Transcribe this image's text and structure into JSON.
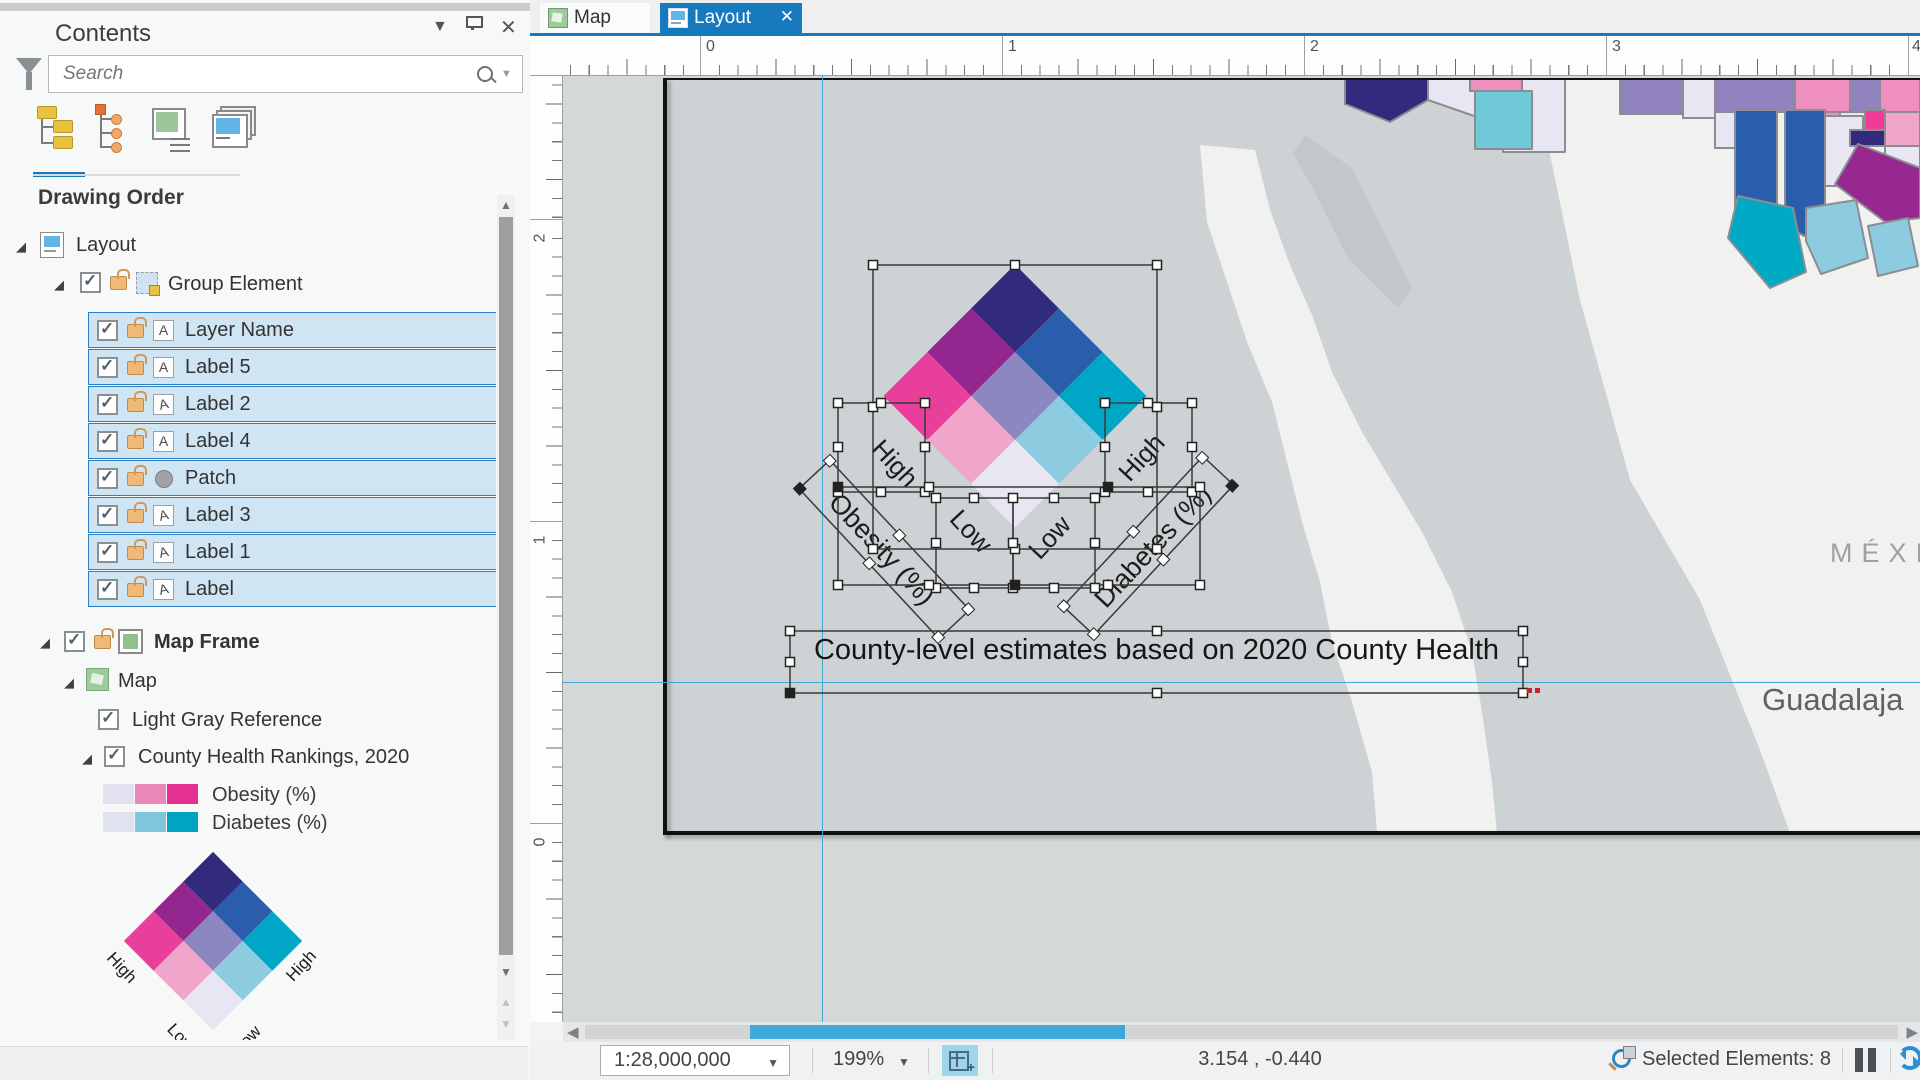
{
  "contents_panel": {
    "title": "Contents",
    "search": {
      "placeholder": "Search"
    },
    "drawing_order_heading": "Drawing Order",
    "tree": {
      "layout": "Layout",
      "group_element": "Group Element",
      "selected_items": [
        "Layer Name",
        "Label 5",
        "Label 2",
        "Label 4",
        "Patch",
        "Label 3",
        "Label 1",
        "Label"
      ],
      "map_frame": "Map Frame",
      "map": "Map",
      "light_gray_layer": "Light Gray Reference",
      "county_health_layer": "County Health Rankings, 2020",
      "legend": [
        {
          "label": "Obesity (%)",
          "ramp": [
            "#e5e0ef",
            "#ec87ba",
            "#e6308f"
          ]
        },
        {
          "label": "Diabetes (%)",
          "ramp": [
            "#dfe3f0",
            "#7fc6dc",
            "#00a3c1"
          ]
        }
      ]
    },
    "mini_legend_labels": {
      "left": "High",
      "right": "High",
      "bottom_left": "Low",
      "bottom_right": "Low"
    }
  },
  "tabs": {
    "map": "Map",
    "layout": "Layout",
    "close": "✕"
  },
  "rulers": {
    "horizontal": [
      "0",
      "1",
      "2",
      "3",
      "4"
    ],
    "vertical": [
      "2",
      "1",
      "0"
    ]
  },
  "layout_view": {
    "bivariate_palette": [
      "#312a7d",
      "#2a5dab",
      "#00a6c6",
      "#93278f",
      "#8d87c1",
      "#8ccbe0",
      "#e83f9a",
      "#f0a5cb",
      "#e9e6f3"
    ],
    "legend_labels": {
      "high_left": "High",
      "high_right": "High",
      "low_left": "Low",
      "low_right": "Low",
      "axis_left": "Obesity (%)",
      "axis_right": "Diabetes (%)"
    },
    "caption": "County-level estimates based on 2020 County Health",
    "map_text": {
      "country": "MÉXI",
      "city": "Guadalaja"
    }
  },
  "status_bar": {
    "scale": "1:28,000,000",
    "zoom": "199%",
    "coordinates": "3.154 , -0.440",
    "selected": "Selected Elements: 8"
  }
}
